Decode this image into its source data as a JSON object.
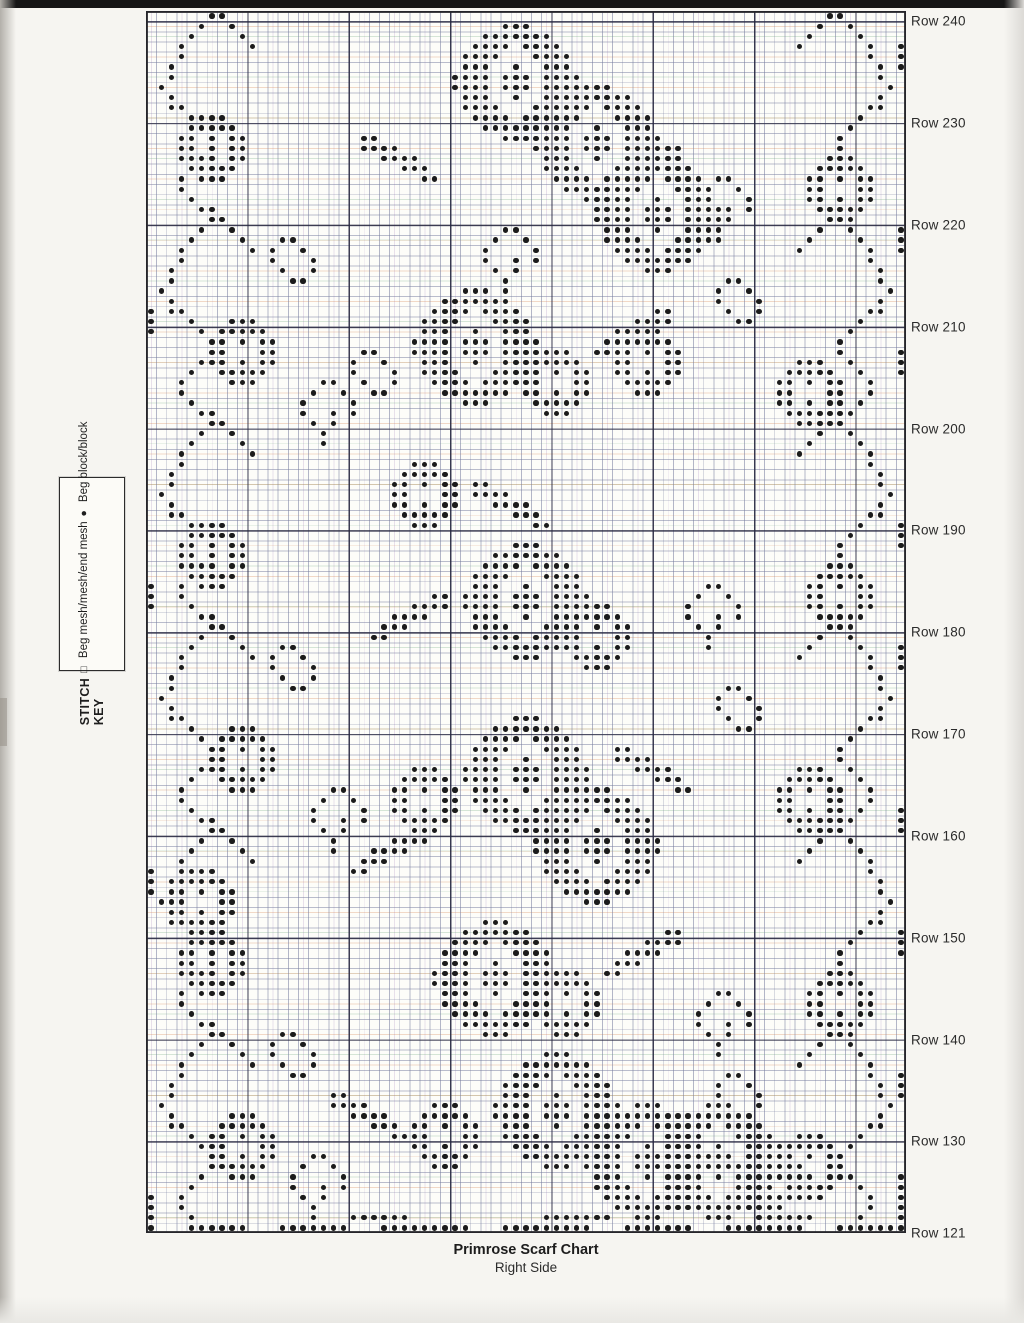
{
  "page": {
    "caption_title": "Primrose Scarf Chart",
    "caption_subtitle": "Right Side"
  },
  "stitch_key": {
    "title": "STITCH KEY",
    "items": [
      {
        "icon": "mesh-open-square",
        "glyph": "□",
        "label": " Beg mesh/mesh/end mesh"
      },
      {
        "icon": "block-filled-dot",
        "glyph": "●",
        "label": " Beg block/block"
      }
    ]
  },
  "row_labels": [
    {
      "text": "Row 240",
      "idx": 1
    },
    {
      "text": "Row 230",
      "idx": 11
    },
    {
      "text": "Row 220",
      "idx": 21
    },
    {
      "text": "Row 210",
      "idx": 31
    },
    {
      "text": "Row 200",
      "idx": 41
    },
    {
      "text": "Row 190",
      "idx": 51
    },
    {
      "text": "Row 180",
      "idx": 61
    },
    {
      "text": "Row 170",
      "idx": 71
    },
    {
      "text": "Row 160",
      "idx": 81
    },
    {
      "text": "Row 150",
      "idx": 91
    },
    {
      "text": "Row 140",
      "idx": 101
    },
    {
      "text": "Row 130",
      "idx": 111
    },
    {
      "text": "Row 121",
      "idx": 120
    }
  ],
  "colors": {
    "dot": "#1b1b1b",
    "grid_bold": "#26262b",
    "grid_thin": "#767c9e",
    "page_bg": "#f6f5f1",
    "chart_bg": "#fdfdf9",
    "top_bar": "#161616"
  },
  "pattern": {
    "cols": 75,
    "rows": 120,
    "motifs": {
      "bloom": [
        ".....###.....",
        "...#######...",
        "..####.####..",
        ".####...####.",
        ".###..#..###.",
        "####.###.####",
        "####.###.####",
        ".###..#..###.",
        ".####...####.",
        "..####.####..",
        "...#######...",
        ".....###....."
      ],
      "bloom_small": [
        "..###..",
        ".#####.",
        "##.#.##",
        "##...##",
        "##.#.##",
        ".#####.",
        "..###.."
      ],
      "leaf": [
        "......##",
        "....####",
        "..####..",
        ".###....",
        "##......"
      ],
      "vine": [
        ".....##...",
        "....#..#..",
        "...#....#.",
        "..#......#",
        "..#.......",
        ".#........",
        ".#........",
        "#.........",
        ".#........",
        ".##.......",
        "...#......",
        "....#.....",
        ".....#....",
        ".....#....",
        "....#.....",
        "...#......",
        "..#.......",
        "..#.......",
        "...#......",
        "....##...."
      ],
      "sprig": [
        "..##..",
        ".#..#.",
        "#....#",
        "#..#.#",
        ".#.#..",
        "..#...",
        "..#..."
      ],
      "curl": [
        ".##..",
        "#..#.",
        "#...#",
        ".#..#",
        "..##."
      ]
    },
    "placements": [
      {
        "m": "vine",
        "c": 1,
        "r": 0
      },
      {
        "m": "vine",
        "c": 1,
        "r": 20
      },
      {
        "m": "vine",
        "c": 1,
        "r": 40
      },
      {
        "m": "vine",
        "c": 1,
        "r": 60
      },
      {
        "m": "vine",
        "c": 1,
        "r": 80
      },
      {
        "m": "vine",
        "c": 1,
        "r": 100
      },
      {
        "m": "vine",
        "c": 64,
        "r": 0,
        "fx": true
      },
      {
        "m": "vine",
        "c": 64,
        "r": 20,
        "fx": true
      },
      {
        "m": "vine",
        "c": 64,
        "r": 40,
        "fx": true
      },
      {
        "m": "vine",
        "c": 64,
        "r": 60,
        "fx": true
      },
      {
        "m": "vine",
        "c": 64,
        "r": 80,
        "fx": true
      },
      {
        "m": "vine",
        "c": 64,
        "r": 100,
        "fx": true
      },
      {
        "m": "bloom_small",
        "c": 3,
        "r": 10
      },
      {
        "m": "bloom_small",
        "c": 6,
        "r": 30
      },
      {
        "m": "bloom_small",
        "c": 3,
        "r": 50
      },
      {
        "m": "bloom_small",
        "c": 6,
        "r": 70
      },
      {
        "m": "bloom_small",
        "c": 2,
        "r": 84
      },
      {
        "m": "bloom_small",
        "c": 3,
        "r": 90
      },
      {
        "m": "bloom_small",
        "c": 6,
        "r": 108
      },
      {
        "m": "bloom_small",
        "c": 65,
        "r": 14
      },
      {
        "m": "bloom_small",
        "c": 62,
        "r": 34
      },
      {
        "m": "bloom_small",
        "c": 65,
        "r": 54
      },
      {
        "m": "bloom_small",
        "c": 62,
        "r": 74
      },
      {
        "m": "bloom_small",
        "c": 65,
        "r": 94
      },
      {
        "m": "bloom_small",
        "c": 62,
        "r": 110
      },
      {
        "m": "curl",
        "c": 12,
        "r": 22
      },
      {
        "m": "curl",
        "c": 12,
        "r": 62
      },
      {
        "m": "curl",
        "c": 12,
        "r": 100
      },
      {
        "m": "curl",
        "c": 56,
        "r": 26
      },
      {
        "m": "curl",
        "c": 56,
        "r": 66
      },
      {
        "m": "curl",
        "c": 56,
        "r": 104
      },
      {
        "m": "curl",
        "c": 20,
        "r": 33
      },
      {
        "m": "sprig",
        "c": 15,
        "r": 36
      },
      {
        "m": "sprig",
        "c": 16,
        "r": 76
      },
      {
        "m": "sprig",
        "c": 14,
        "r": 112
      },
      {
        "m": "sprig",
        "c": 54,
        "r": 16
      },
      {
        "m": "sprig",
        "c": 53,
        "r": 56
      },
      {
        "m": "sprig",
        "c": 54,
        "r": 96
      },
      {
        "m": "sprig",
        "c": 33,
        "r": 21
      },
      {
        "m": "bloom",
        "c": 30,
        "r": 1
      },
      {
        "m": "bloom",
        "c": 38,
        "r": 7
      },
      {
        "m": "leaf",
        "c": 21,
        "r": 12,
        "fx": true
      },
      {
        "m": "leaf",
        "c": 45,
        "r": 13
      },
      {
        "m": "bloom",
        "c": 44,
        "r": 14
      },
      {
        "m": "bloom",
        "c": 26,
        "r": 27
      },
      {
        "m": "bloom_small",
        "c": 37,
        "r": 33
      },
      {
        "m": "leaf",
        "c": 44,
        "r": 29
      },
      {
        "m": "bloom_small",
        "c": 46,
        "r": 31
      },
      {
        "m": "bloom_small",
        "c": 24,
        "r": 44
      },
      {
        "m": "leaf",
        "c": 32,
        "r": 46,
        "fx": true
      },
      {
        "m": "bloom",
        "c": 31,
        "r": 52
      },
      {
        "m": "bloom_small",
        "c": 41,
        "r": 58
      },
      {
        "m": "leaf",
        "c": 22,
        "r": 57
      },
      {
        "m": "bloom",
        "c": 31,
        "r": 69
      },
      {
        "m": "bloom",
        "c": 38,
        "r": 76
      },
      {
        "m": "bloom_small",
        "c": 24,
        "r": 74
      },
      {
        "m": "leaf",
        "c": 46,
        "r": 72,
        "fx": true
      },
      {
        "m": "leaf",
        "c": 20,
        "r": 80
      },
      {
        "m": "bloom",
        "c": 28,
        "r": 89
      },
      {
        "m": "bloom_small",
        "c": 38,
        "r": 94
      },
      {
        "m": "leaf",
        "c": 45,
        "r": 90
      },
      {
        "m": "bloom",
        "c": 34,
        "r": 102
      },
      {
        "m": "bloom",
        "c": 43,
        "r": 107
      },
      {
        "m": "bloom_small",
        "c": 26,
        "r": 107
      },
      {
        "m": "leaf",
        "c": 18,
        "r": 106,
        "fx": true
      },
      {
        "m": "bloom",
        "c": 50,
        "r": 107
      },
      {
        "m": "bloom_small",
        "c": 58,
        "r": 111
      }
    ],
    "row_runs": [
      {
        "r": 119,
        "runs": [
          [
            0,
            0
          ],
          [
            4,
            9
          ],
          [
            13,
            19
          ],
          [
            23,
            31
          ],
          [
            35,
            43
          ],
          [
            47,
            53
          ],
          [
            57,
            64
          ],
          [
            68,
            74
          ]
        ]
      },
      {
        "r": 118,
        "runs": [
          [
            0,
            0
          ],
          [
            20,
            25
          ],
          [
            39,
            45
          ],
          [
            60,
            65
          ],
          [
            74,
            74
          ]
        ]
      }
    ],
    "col_runs": [
      {
        "c": 0,
        "runs": [
          [
            29,
            31
          ],
          [
            56,
            58
          ],
          [
            84,
            86
          ],
          [
            116,
            118
          ]
        ]
      },
      {
        "c": 74,
        "runs": [
          [
            3,
            5
          ],
          [
            21,
            23
          ],
          [
            33,
            35
          ],
          [
            50,
            52
          ],
          [
            62,
            64
          ],
          [
            78,
            80
          ],
          [
            90,
            92
          ],
          [
            104,
            106
          ],
          [
            114,
            118
          ]
        ]
      }
    ]
  }
}
